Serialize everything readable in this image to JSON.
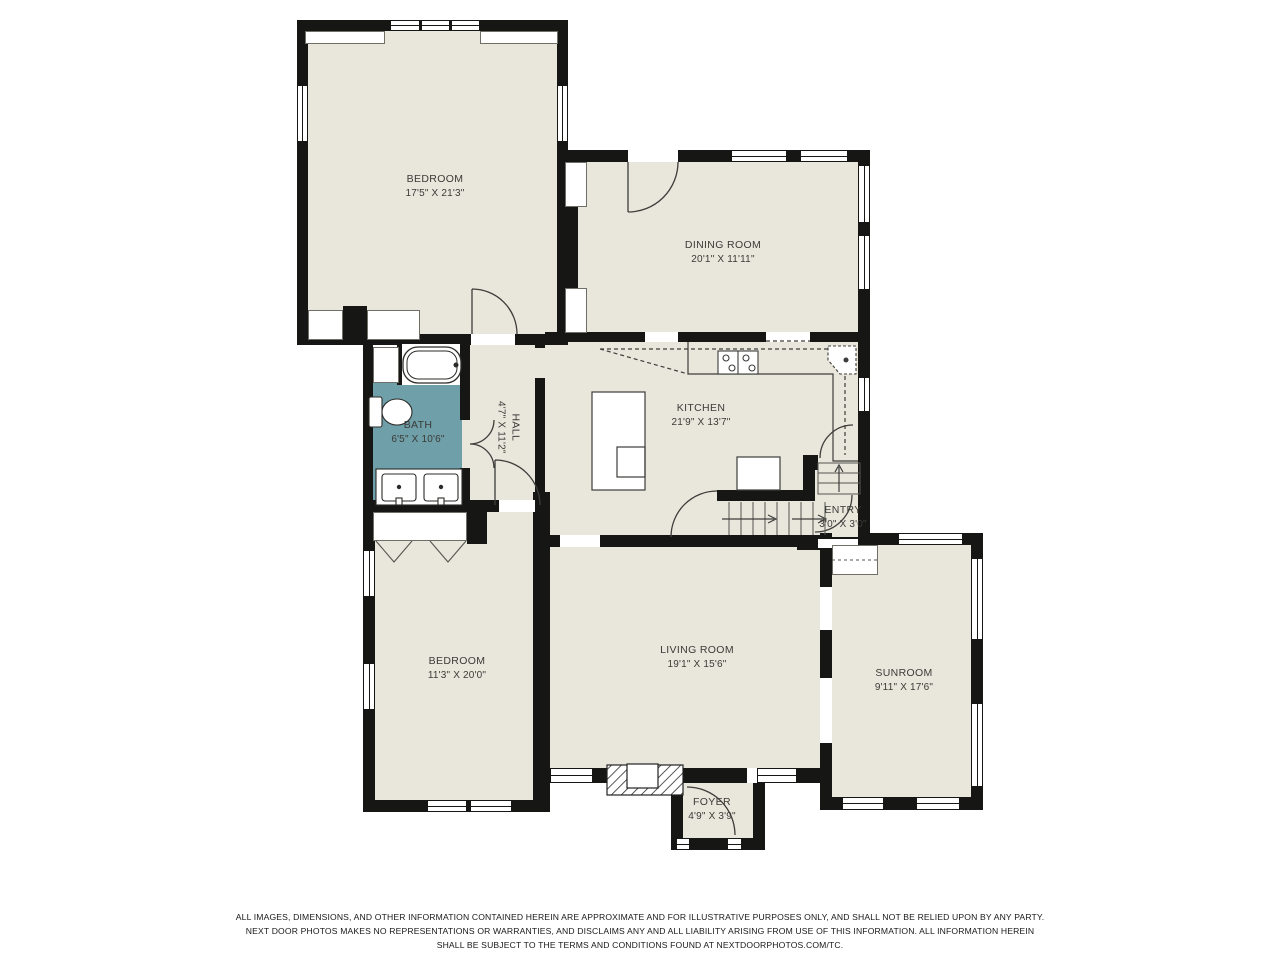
{
  "plan": {
    "rooms": [
      {
        "id": "bedroom-1",
        "name": "BEDROOM",
        "dims": "17'5\" X 21'3\""
      },
      {
        "id": "dining-room",
        "name": "DINING ROOM",
        "dims": "20'1\" X 11'11\""
      },
      {
        "id": "bath",
        "name": "BATH",
        "dims": "6'5\" X 10'6\""
      },
      {
        "id": "hall",
        "name": "HALL",
        "dims": "4'7\" X 11'2\""
      },
      {
        "id": "kitchen",
        "name": "KITCHEN",
        "dims": "21'9\" X 13'7\""
      },
      {
        "id": "entry",
        "name": "ENTRY",
        "dims": "3'0\" X 3'0\""
      },
      {
        "id": "bedroom-2",
        "name": "BEDROOM",
        "dims": "11'3\" X 20'0\""
      },
      {
        "id": "living-room",
        "name": "LIVING ROOM",
        "dims": "19'1\" X 15'6\""
      },
      {
        "id": "sunroom",
        "name": "SUNROOM",
        "dims": "9'11\" X 17'6\""
      },
      {
        "id": "foyer",
        "name": "FOYER",
        "dims": "4'9\" X 3'9\""
      }
    ],
    "colors": {
      "floor": "#e9e6dc",
      "bath": "#6f9fa9",
      "wall": "#161614",
      "line": "#3d3d3a"
    },
    "disclaimer": {
      "line1": "ALL IMAGES, DIMENSIONS, AND OTHER INFORMATION CONTAINED HEREIN ARE APPROXIMATE AND FOR ILLUSTRATIVE PURPOSES ONLY, AND SHALL NOT BE RELIED UPON BY ANY PARTY.",
      "line2": "NEXT DOOR PHOTOS MAKES NO REPRESENTATIONS OR WARRANTIES, AND DISCLAIMS ANY AND ALL LIABILITY ARISING FROM USE OF THIS INFORMATION. ALL INFORMATION HEREIN",
      "line3": "SHALL BE SUBJECT TO THE TERMS AND CONDITIONS FOUND AT NEXTDOORPHOTOS.COM/TC."
    }
  }
}
